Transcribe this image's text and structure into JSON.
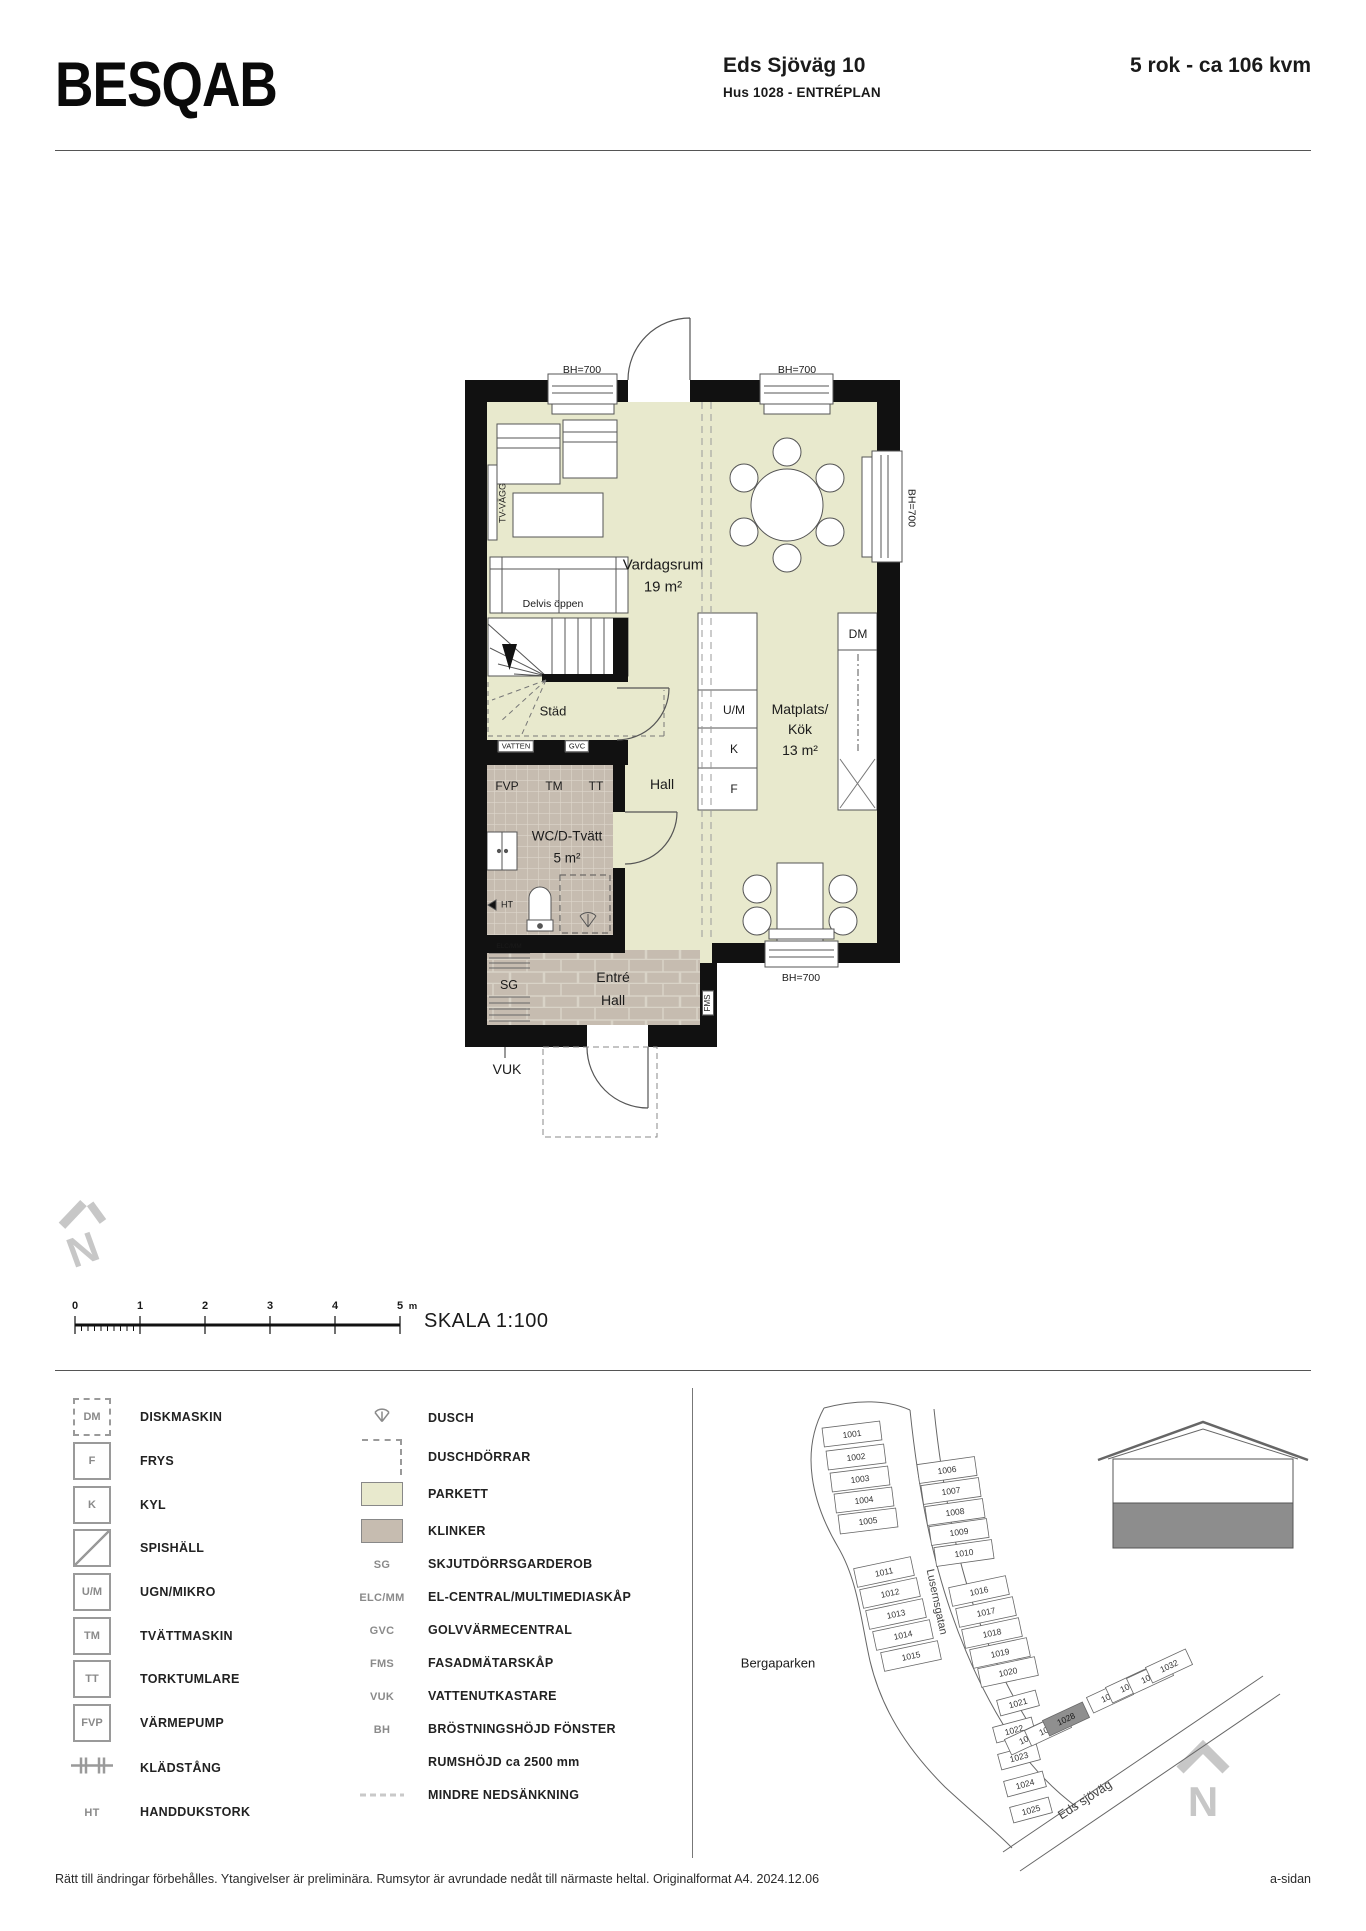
{
  "header": {
    "logo": "BESQAB",
    "address": "Eds Sjöväg  10",
    "size": "5 rok - ca 106 kvm",
    "plan_name": "Hus 1028 - ENTRÉPLAN"
  },
  "floorplan": {
    "bh700": "BH=700",
    "tv_vagg": "TV-VÄGG",
    "delvis": "Delvis öppen",
    "rooms": {
      "vardagsrum": "Vardagsrum",
      "vardagsrum_area": "19 m²",
      "matplats1": "Matplats/",
      "matplats2": "Kök",
      "matplats_area": "13 m²",
      "hall": "Hall",
      "wc": "WC/D-Tvätt",
      "wc_area": "5 m²",
      "entre1": "Entré",
      "entre2": "Hall",
      "stad": "Städ"
    },
    "tags": {
      "vatten": "VATTEN",
      "gvc": "GVC",
      "fvp": "FVP",
      "tm": "TM",
      "tt": "TT",
      "um": "U/M",
      "k": "K",
      "f": "F",
      "dm": "DM",
      "sg": "SG",
      "elcmm": "ELC/MM",
      "ht": "HT",
      "fms": "FMS",
      "vuk": "VUK"
    }
  },
  "scalebar": {
    "ticks": [
      "0",
      "1",
      "2",
      "3",
      "4",
      "5"
    ],
    "unit": "m",
    "label": "SKALA 1:100"
  },
  "legend": {
    "col1": [
      {
        "icon": "box-dashed",
        "abbr": "DM",
        "desc": "DISKMASKIN"
      },
      {
        "icon": "box",
        "abbr": "F",
        "desc": "FRYS"
      },
      {
        "icon": "box",
        "abbr": "K",
        "desc": "KYL"
      },
      {
        "icon": "box-diag",
        "abbr": "",
        "desc": "SPISHÄLL"
      },
      {
        "icon": "box",
        "abbr": "U/M",
        "desc": "UGN/MIKRO"
      },
      {
        "icon": "box",
        "abbr": "TM",
        "desc": "TVÄTTMASKIN"
      },
      {
        "icon": "box",
        "abbr": "TT",
        "desc": "TORKTUMLARE"
      },
      {
        "icon": "box",
        "abbr": "FVP",
        "desc": "VÄRMEPUMP"
      },
      {
        "icon": "rail",
        "abbr": "",
        "desc": "KLÄDSTÅNG"
      },
      {
        "icon": "text",
        "abbr": "HT",
        "desc": "HANDDUKSTORK"
      }
    ],
    "col2": [
      {
        "icon": "shower",
        "abbr": "",
        "desc": "DUSCH"
      },
      {
        "icon": "corner-dashed",
        "abbr": "",
        "desc": "DUSCHDÖRRAR"
      },
      {
        "icon": "swatch-parkett",
        "abbr": "",
        "desc": "PARKETT"
      },
      {
        "icon": "swatch-klinker",
        "abbr": "",
        "desc": "KLINKER"
      },
      {
        "icon": "text",
        "abbr": "SG",
        "desc": "SKJUTDÖRRSGARDEROB"
      },
      {
        "icon": "text",
        "abbr": "ELC/MM",
        "desc": "EL-CENTRAL/MULTIMEDIASKÅP"
      },
      {
        "icon": "text",
        "abbr": "GVC",
        "desc": "GOLVVÄRMECENTRAL"
      },
      {
        "icon": "text",
        "abbr": "FMS",
        "desc": "FASADMÄTARSKÅP"
      },
      {
        "icon": "text",
        "abbr": "VUK",
        "desc": "VATTENUTKASTARE"
      },
      {
        "icon": "text",
        "abbr": "BH",
        "desc": "BRÖSTNINGSHÖJD  FÖNSTER"
      },
      {
        "icon": "none",
        "abbr": "",
        "desc": "RUMSHÖJD ca 2500 mm"
      },
      {
        "icon": "dashes",
        "abbr": "",
        "desc": "MINDRE NEDSÄNKNING"
      }
    ]
  },
  "sitemap": {
    "park": "Bergaparken",
    "street_lusern": "Lusernsgatan",
    "street_eds": "Eds sjöväg",
    "north": "N",
    "highlighted_lot": "1028",
    "lots": [
      {
        "n": "1001",
        "x": 852,
        "y": 1434,
        "a": -7,
        "w": 58,
        "h": 19
      },
      {
        "n": "1002",
        "x": 856,
        "y": 1457,
        "a": -7,
        "w": 58,
        "h": 19
      },
      {
        "n": "1003",
        "x": 860,
        "y": 1479,
        "a": -7,
        "w": 58,
        "h": 19
      },
      {
        "n": "1004",
        "x": 864,
        "y": 1500,
        "a": -7,
        "w": 58,
        "h": 19
      },
      {
        "n": "1005",
        "x": 868,
        "y": 1521,
        "a": -7,
        "w": 58,
        "h": 19
      },
      {
        "n": "1006",
        "x": 947,
        "y": 1470,
        "a": -8,
        "w": 58,
        "h": 19
      },
      {
        "n": "1007",
        "x": 951,
        "y": 1491,
        "a": -8,
        "w": 58,
        "h": 19
      },
      {
        "n": "1008",
        "x": 955,
        "y": 1512,
        "a": -8,
        "w": 58,
        "h": 19
      },
      {
        "n": "1009",
        "x": 959,
        "y": 1532,
        "a": -8,
        "w": 58,
        "h": 19
      },
      {
        "n": "1010",
        "x": 964,
        "y": 1553,
        "a": -8,
        "w": 58,
        "h": 19
      },
      {
        "n": "1011",
        "x": 884,
        "y": 1572,
        "a": -12,
        "w": 58,
        "h": 19
      },
      {
        "n": "1012",
        "x": 890,
        "y": 1593,
        "a": -12,
        "w": 58,
        "h": 19
      },
      {
        "n": "1013",
        "x": 896,
        "y": 1614,
        "a": -12,
        "w": 58,
        "h": 19
      },
      {
        "n": "1014",
        "x": 903,
        "y": 1635,
        "a": -12,
        "w": 58,
        "h": 19
      },
      {
        "n": "1015",
        "x": 911,
        "y": 1656,
        "a": -12,
        "w": 58,
        "h": 19
      },
      {
        "n": "1016",
        "x": 979,
        "y": 1591,
        "a": -12,
        "w": 58,
        "h": 19
      },
      {
        "n": "1017",
        "x": 986,
        "y": 1612,
        "a": -12,
        "w": 58,
        "h": 19
      },
      {
        "n": "1018",
        "x": 992,
        "y": 1633,
        "a": -12,
        "w": 58,
        "h": 19
      },
      {
        "n": "1019",
        "x": 1000,
        "y": 1653,
        "a": -12,
        "w": 58,
        "h": 19
      },
      {
        "n": "1020",
        "x": 1008,
        "y": 1672,
        "a": -12,
        "w": 58,
        "h": 19
      },
      {
        "n": "1021",
        "x": 1018,
        "y": 1703,
        "a": -15,
        "w": 40,
        "h": 16
      },
      {
        "n": "1022",
        "x": 1014,
        "y": 1730,
        "a": -15,
        "w": 40,
        "h": 16
      },
      {
        "n": "1023",
        "x": 1019,
        "y": 1757,
        "a": -15,
        "w": 40,
        "h": 16
      },
      {
        "n": "1024",
        "x": 1025,
        "y": 1784,
        "a": -15,
        "w": 40,
        "h": 16
      },
      {
        "n": "1025",
        "x": 1031,
        "y": 1810,
        "a": -15,
        "w": 40,
        "h": 16
      },
      {
        "n": "1026",
        "x": 1028,
        "y": 1738,
        "a": -25,
        "w": 44,
        "h": 17
      },
      {
        "n": "1027",
        "x": 1048,
        "y": 1729,
        "a": -25,
        "w": 44,
        "h": 17
      },
      {
        "n": "1028",
        "x": 1066,
        "y": 1719,
        "a": -25,
        "w": 44,
        "h": 17,
        "hl": true
      },
      {
        "n": "1029",
        "x": 1110,
        "y": 1696,
        "a": -25,
        "w": 44,
        "h": 17
      },
      {
        "n": "1030",
        "x": 1129,
        "y": 1686,
        "a": -25,
        "w": 44,
        "h": 17
      },
      {
        "n": "1031",
        "x": 1150,
        "y": 1677,
        "a": -25,
        "w": 44,
        "h": 17
      },
      {
        "n": "1032",
        "x": 1169,
        "y": 1666,
        "a": -25,
        "w": 44,
        "h": 17
      }
    ]
  },
  "footer": {
    "disclaimer": "Rätt till ändringar förbehålles. Ytangivelser är preliminära. Rumsytor är avrundade nedåt till närmaste heltal. Originalformat A4. 2024.12.06",
    "side": "a-sidan"
  },
  "colors": {
    "parkett": "#e8e9cd",
    "klinker": "#c6bcb0",
    "wall": "#111111",
    "lot_highlight": "#8f8f8f"
  }
}
